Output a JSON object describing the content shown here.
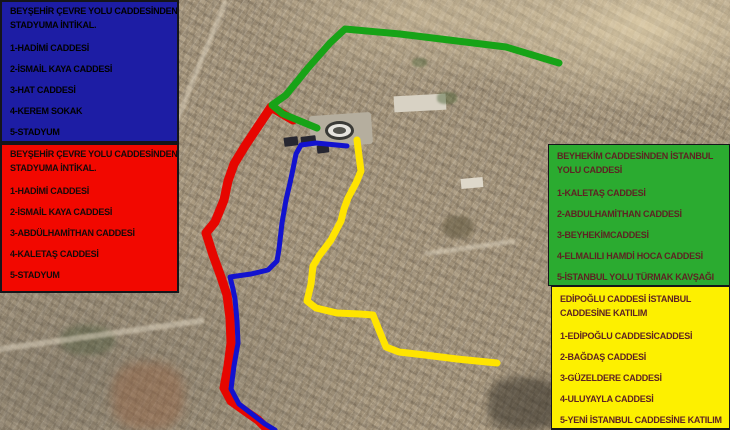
{
  "boxes": {
    "blue": {
      "bg": "#1d1da4",
      "text_color": "#000000",
      "title_lines": [
        "BEYŞEHİR ÇEVRE YOLU CADDESİNDEN",
        "STADYUMA İNTİKAL."
      ],
      "items": [
        "1-HADİMİ CADDESİ",
        "2-İSMAİL KAYA CADDESİ",
        "3-HAT CADDESİ",
        "4-KEREM SOKAK",
        "5-STADYUM"
      ]
    },
    "red": {
      "bg": "#f20800",
      "text_color": "#140a0a",
      "title_lines": [
        "BEYŞEHİR ÇEVRE YOLU CADDESİNDEN",
        "STADYUMA İNTİKAL."
      ],
      "items": [
        "1-HADİMİ CADDESİ",
        "2-İSMAİL KAYA CADDESİ",
        "3-ABDÜLHAMİTHAN CADDESİ",
        "4-KALETAŞ CADDESİ",
        "5-STADYUM"
      ]
    },
    "green": {
      "bg": "#2bab30",
      "text_color": "#5e2323",
      "title_lines": [
        "BEYHEKİM  CADDESİNDEN İSTANBUL",
        "YOLU CADDESİ"
      ],
      "items": [
        "1-KALETAŞ  CADDESİ",
        "2-ABDULHAMİTHAN CADDESİ",
        "3-BEYHEKİMCADDESİ",
        "4-ELMALILI HAMDİ HOCA CADDESİ",
        "5-İSTANBUL YOLU TÜRMAK KAVŞAĞI"
      ]
    },
    "yellow": {
      "bg": "#fdf000",
      "text_color": "#5e2323",
      "title_lines": [
        "EDİPOĞLU CADDESİ İSTANBUL",
        "CADDESİNE KATILIM"
      ],
      "items": [
        "1-EDİPOĞLU CADDESİCADDESİ",
        "2-BAĞDAŞ CADDESİ",
        "3-GÜZELDERE  CADDESİ",
        "4-ULUYAYLA CADDESİ",
        "5-YENİ İSTANBUL CADDESİNE KATILIM"
      ]
    }
  },
  "map": {
    "base_color": "#ab9b81",
    "routes": [
      {
        "name": "red",
        "color": "#e60600",
        "width": 9,
        "points": [
          [
            293,
            120
          ],
          [
            271,
            107
          ],
          [
            257,
            128
          ],
          [
            245,
            146
          ],
          [
            234,
            164
          ],
          [
            228,
            181
          ],
          [
            224,
            200
          ],
          [
            215,
            222
          ],
          [
            206,
            233
          ],
          [
            213,
            255
          ],
          [
            221,
            277
          ],
          [
            227,
            295
          ],
          [
            230,
            318
          ],
          [
            231,
            343
          ],
          [
            228,
            366
          ],
          [
            224,
            388
          ],
          [
            231,
            401
          ],
          [
            245,
            411
          ],
          [
            258,
            420
          ],
          [
            268,
            430
          ]
        ]
      },
      {
        "name": "green",
        "color": "#17a317",
        "width": 7,
        "points": [
          [
            559,
            63
          ],
          [
            506,
            47
          ],
          [
            400,
            34
          ],
          [
            345,
            29
          ],
          [
            330,
            43
          ],
          [
            308,
            68
          ],
          [
            286,
            95
          ],
          [
            272,
            105
          ],
          [
            283,
            114
          ],
          [
            300,
            121
          ],
          [
            317,
            128
          ]
        ]
      },
      {
        "name": "blue",
        "color": "#1212cf",
        "width": 5,
        "points": [
          [
            347,
            146
          ],
          [
            316,
            143
          ],
          [
            301,
            145
          ],
          [
            296,
            154
          ],
          [
            293,
            169
          ],
          [
            290,
            183
          ],
          [
            286,
            200
          ],
          [
            282,
            223
          ],
          [
            279,
            249
          ],
          [
            277,
            261
          ],
          [
            268,
            270
          ],
          [
            251,
            274
          ],
          [
            230,
            277
          ],
          [
            233,
            289
          ],
          [
            235,
            299
          ],
          [
            237,
            321
          ],
          [
            238,
            343
          ],
          [
            234,
            366
          ],
          [
            231,
            389
          ],
          [
            239,
            404
          ],
          [
            252,
            414
          ],
          [
            265,
            424
          ],
          [
            275,
            430
          ]
        ]
      },
      {
        "name": "yellow",
        "color": "#ffe400",
        "width": 7,
        "points": [
          [
            357,
            140
          ],
          [
            359,
            156
          ],
          [
            361,
            171
          ],
          [
            356,
            183
          ],
          [
            348,
            198
          ],
          [
            344,
            209
          ],
          [
            341,
            221
          ],
          [
            331,
            240
          ],
          [
            319,
            256
          ],
          [
            313,
            266
          ],
          [
            311,
            284
          ],
          [
            307,
            301
          ],
          [
            316,
            308
          ],
          [
            337,
            313
          ],
          [
            360,
            314
          ],
          [
            373,
            315
          ],
          [
            379,
            330
          ],
          [
            386,
            347
          ],
          [
            399,
            352
          ],
          [
            425,
            355
          ],
          [
            457,
            359
          ],
          [
            497,
            363
          ]
        ]
      }
    ]
  }
}
